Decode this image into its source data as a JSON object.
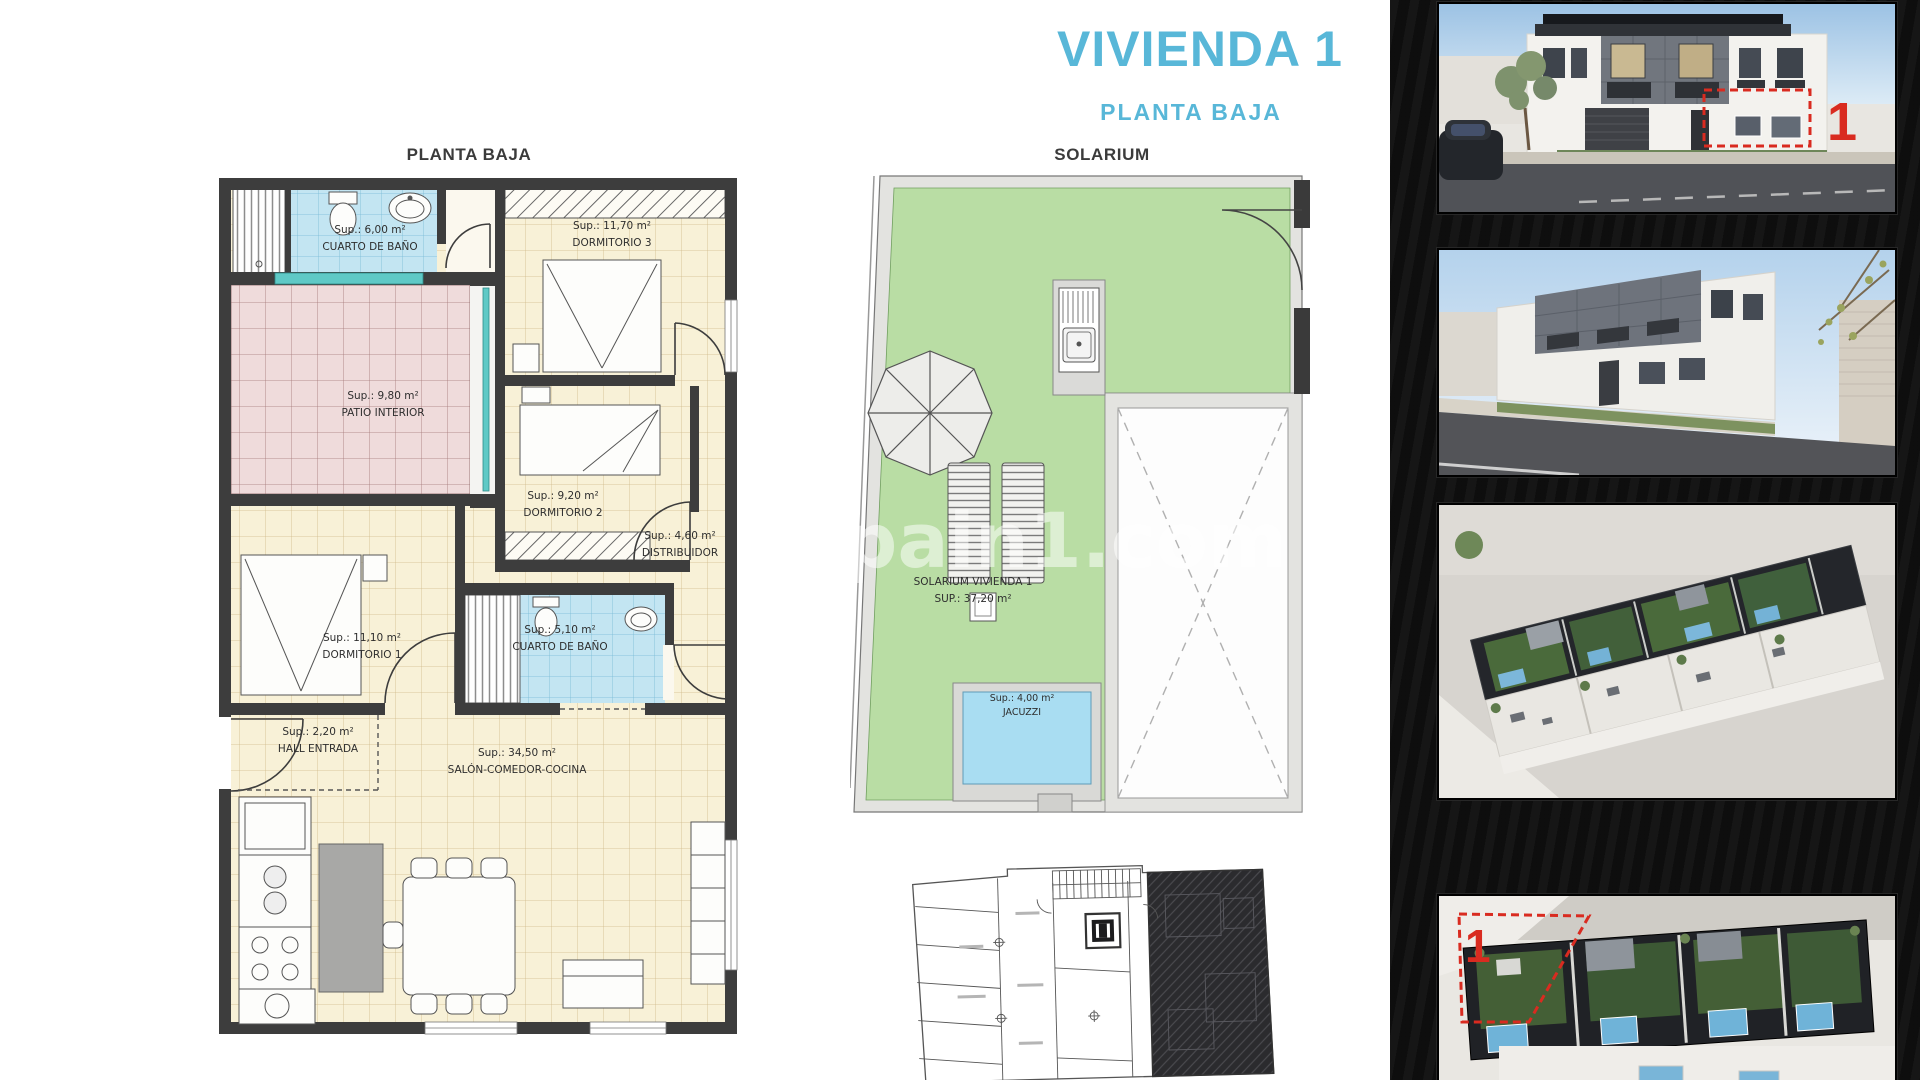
{
  "header": {
    "title": "VIVIENDA 1",
    "subtitle": "PLANTA BAJA"
  },
  "floorplan": {
    "title": "PLANTA BAJA",
    "rooms": {
      "bath1": {
        "area": "Sup.: 6,00 m²",
        "name": "CUARTO DE BAÑO"
      },
      "dorm3": {
        "area": "Sup.: 11,70 m²",
        "name": "DORMITORIO 3"
      },
      "patio": {
        "area": "Sup.: 9,80 m²",
        "name": "PATIO INTERIOR"
      },
      "dorm2": {
        "area": "Sup.: 9,20 m²",
        "name": "DORMITORIO 2"
      },
      "distribuidor": {
        "area": "Sup.: 4,60 m²",
        "name": "DISTRIBUIDOR"
      },
      "dorm1": {
        "area": "Sup.: 11,10 m²",
        "name": "DORMITORIO 1"
      },
      "bath2": {
        "area": "Sup.: 5,10 m²",
        "name": "CUARTO DE BAÑO"
      },
      "hall": {
        "area": "Sup.: 2,20 m²",
        "name": "HALL ENTRADA"
      },
      "salon": {
        "area": "Sup.: 34,50 m²",
        "name": "SALÓN-COMEDOR-COCINA"
      }
    }
  },
  "solarium": {
    "title": "SOLARIUM",
    "label": {
      "line1": "SOLARIUM VIVIENDA 1",
      "line2": "SUP.: 37,20 m²"
    },
    "jacuzzi": {
      "area": "Sup.: 4,00 m²",
      "name": "JACUZZI"
    }
  },
  "watermark": {
    "text": "pain1.com"
  },
  "sidebar": {
    "markers": {
      "photo1": "1",
      "photo4": "1"
    }
  },
  "colors": {
    "accent_teal": "#58b7d8",
    "marker_red": "#d92b20",
    "plan_cream": "#f8f1d7",
    "plan_blue": "#c3e5f2",
    "plan_pink": "#efdbdb",
    "plan_green": "#b9dda4"
  }
}
